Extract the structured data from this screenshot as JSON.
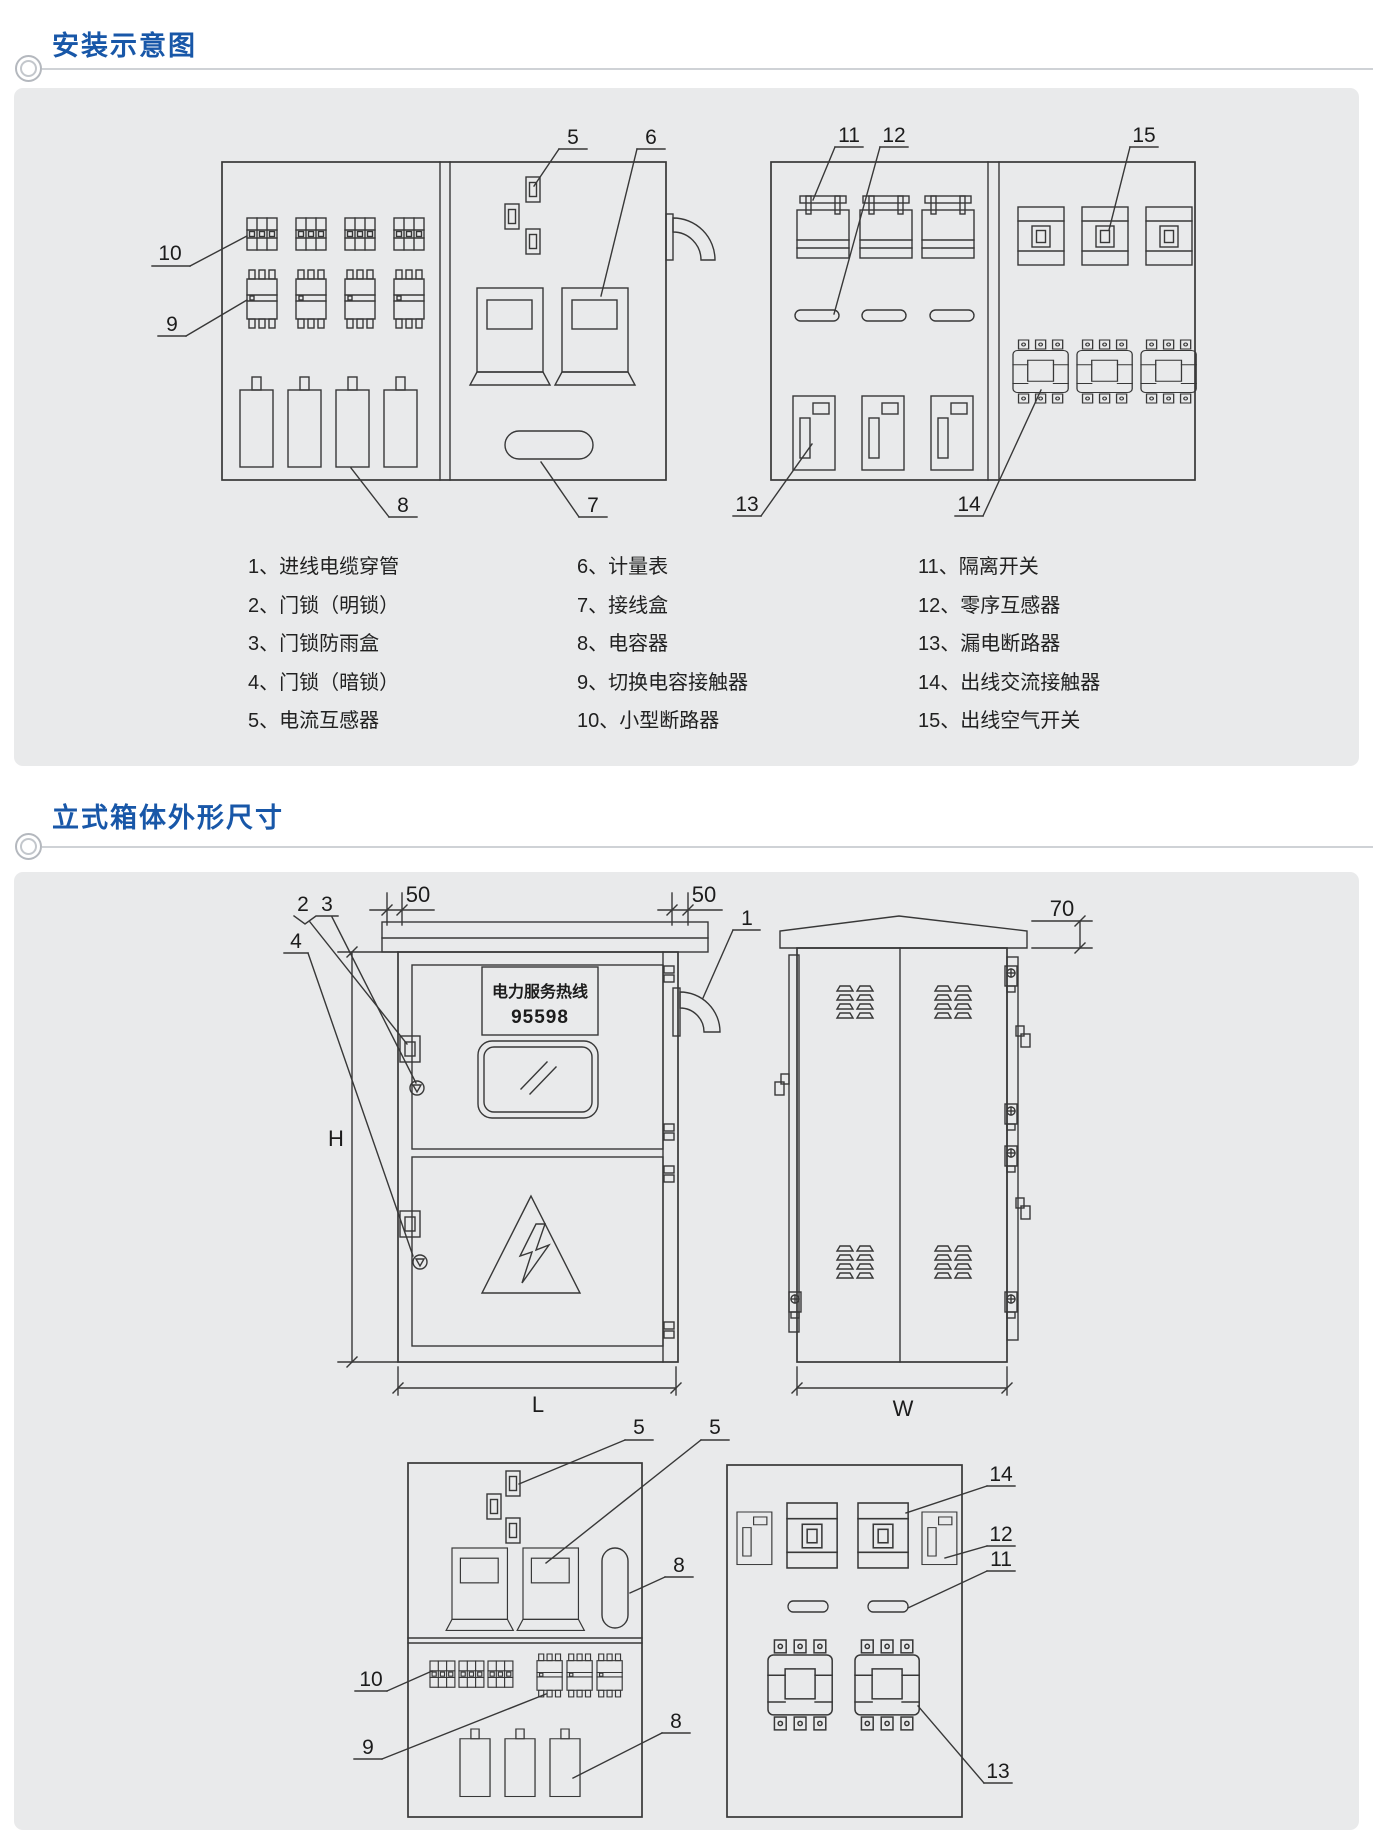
{
  "sections": {
    "s1_title": "安装示意图",
    "s2_title": "立式箱体外形尺寸"
  },
  "legend": {
    "col1": [
      "1、进线电缆穿管",
      "2、门锁（明锁）",
      "3、门锁防雨盒",
      "4、门锁（暗锁）",
      "5、电流互感器"
    ],
    "col2": [
      "6、计量表",
      "7、接线盒",
      "8、电容器",
      "9、切换电容接触器",
      "10、小型断路器"
    ],
    "col3": [
      "11、隔离开关",
      "12、零序互感器",
      "13、漏电断路器",
      "14、出线交流接触器",
      "15、出线空气开关"
    ]
  },
  "install_diagram": {
    "callouts": {
      "c5": "5",
      "c6": "6",
      "c7": "7",
      "c8": "8",
      "c9": "9",
      "c10": "10",
      "c11": "11",
      "c12": "12",
      "c13": "13",
      "c14": "14",
      "c15": "15"
    }
  },
  "dimension_diagram": {
    "callouts": {
      "c1": "1",
      "c2": "2",
      "c3": "3",
      "c4": "4",
      "c5a": "5",
      "c5b": "5",
      "c8a": "8",
      "c8b": "8",
      "c9": "9",
      "c10": "10",
      "c11": "11",
      "c12": "12",
      "c13": "13",
      "c14": "14"
    },
    "dims": {
      "left50": "50",
      "right50": "50",
      "roof70": "70",
      "height": "H",
      "length": "L",
      "width": "W"
    },
    "hotline": {
      "line1": "电力服务热线",
      "line2": "95598"
    }
  },
  "colors": {
    "title_blue": "#1857a8",
    "panel_bg": "#e9eaeb",
    "line": "#383838"
  }
}
